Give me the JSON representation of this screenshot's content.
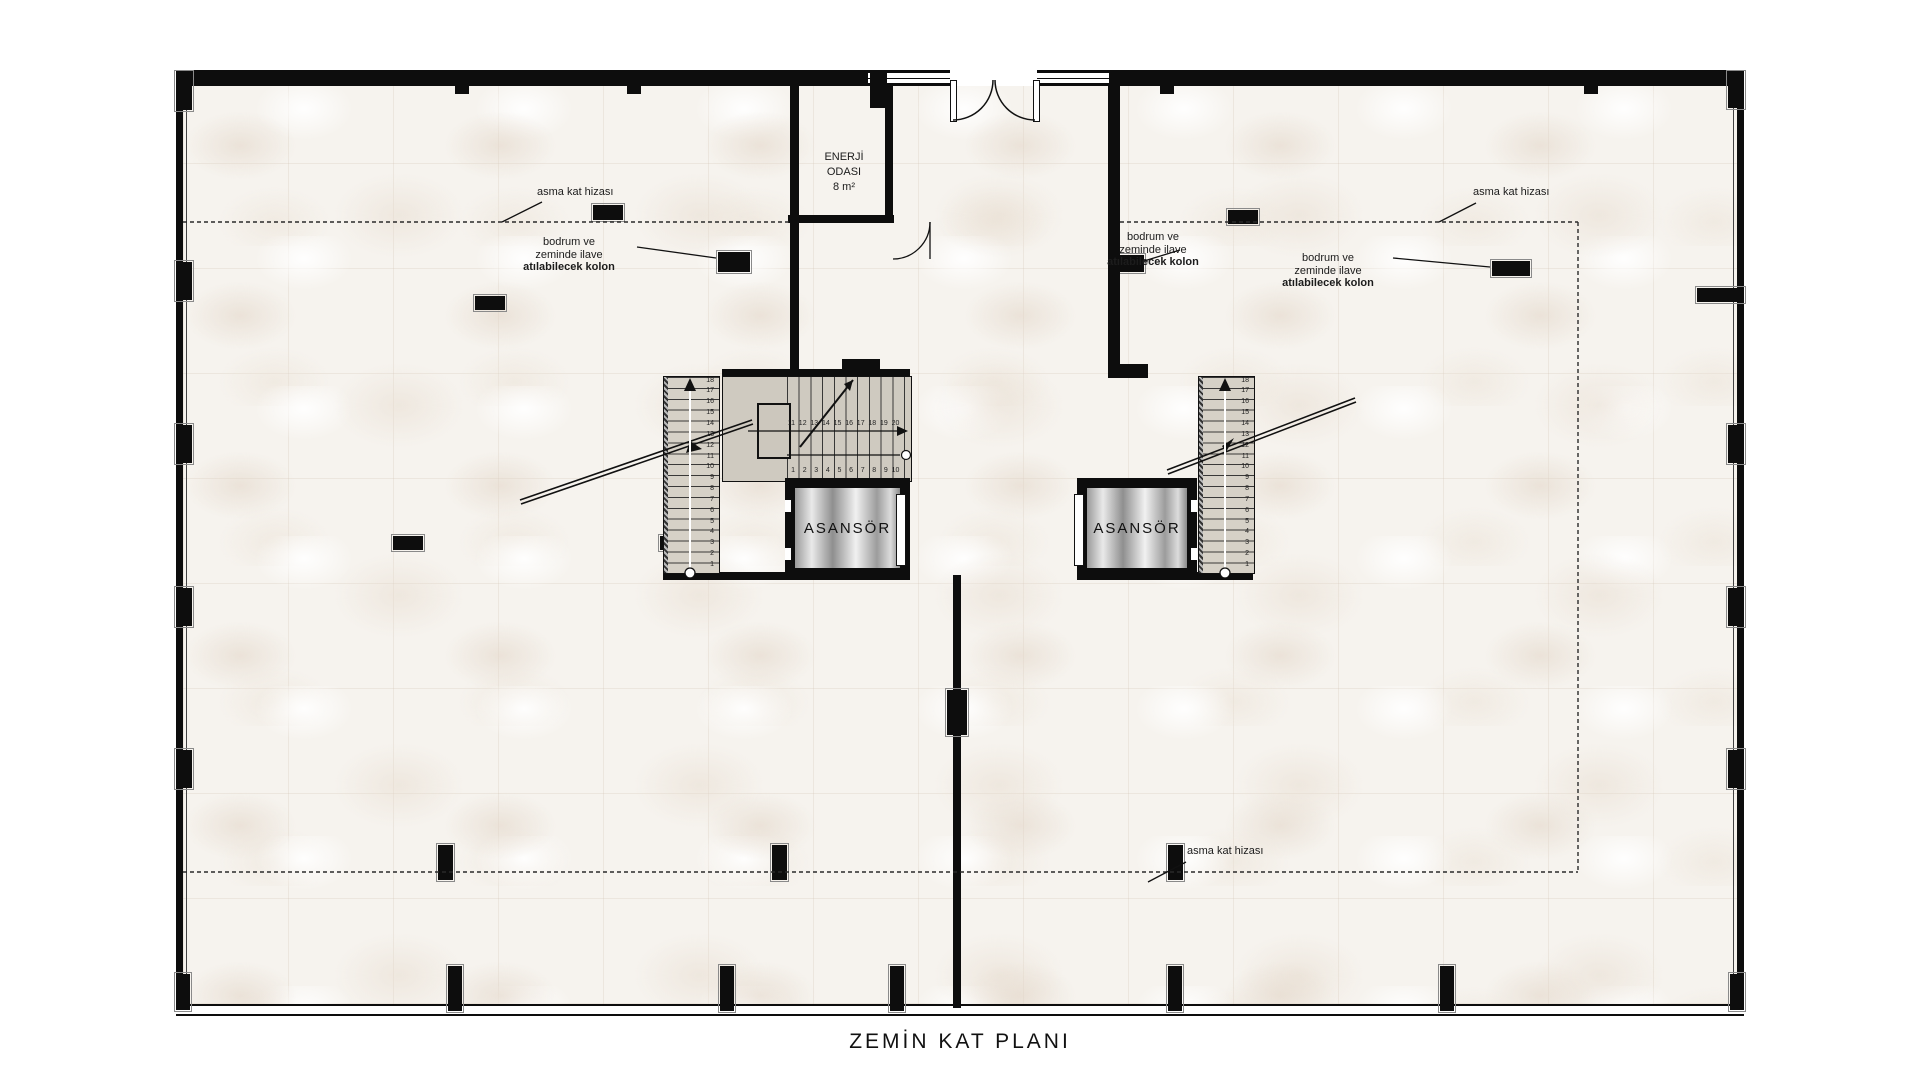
{
  "page_title": "ZEMİN KAT PLANI",
  "energy_room": {
    "line1": "ENERJİ",
    "line2": "ODASI",
    "area": "8 m²"
  },
  "elevator_label": "ASANSÖR",
  "mezzanine_note": "asma kat hizası",
  "column_note": {
    "line1": "bodrum ve",
    "line2": "zeminde ilave",
    "line3": "atılabilecek  kolon"
  },
  "stairs": {
    "left_flight": [
      1,
      2,
      3,
      4,
      5,
      6,
      7,
      8,
      9,
      10,
      11,
      12,
      13,
      14,
      15,
      16,
      17,
      18
    ],
    "right_flight": [
      1,
      2,
      3,
      4,
      5,
      6,
      7,
      8,
      9,
      10,
      11,
      12,
      13,
      14,
      15,
      16,
      17,
      18
    ],
    "upper_mid": [
      11,
      12,
      13,
      14,
      15,
      16,
      17,
      18,
      19,
      20
    ],
    "upper_low": [
      1,
      2,
      3,
      4,
      5,
      6,
      7,
      8,
      9,
      10
    ]
  },
  "colors": {
    "wall": "#0d0d0d",
    "floor": "#f6f3ee",
    "stair_fill": "#d6d1c7",
    "elevator_silver": "#c9c9c9",
    "dashed_line": "#2a2a2a"
  }
}
